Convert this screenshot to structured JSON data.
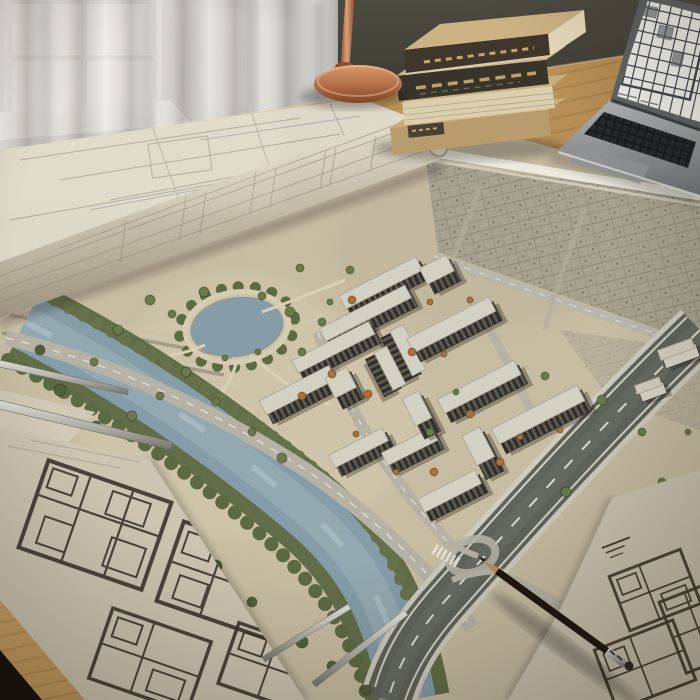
{
  "scene": {
    "description": "Photorealistic architect's desk: rolled blueprint, aerial 3D site-plan map of a riverside residential development blended into the tabletop, floor-plan sheets, pencil, metal rulers, stack of books, copper desk lamp, laptop showing a floor plan, sheer-curtained window",
    "legible_text": "none (all drawing annotations and book-spine lettering are illegible)"
  },
  "palette": {
    "sand": "#c7bda3",
    "sandLight": "#d4cbb0",
    "water": "#849da9",
    "bank": "#57643f",
    "roadLight": "#b6b3a6",
    "roadDark": "#60645b",
    "roof": "#d3d0c4",
    "wood": "#c59d63",
    "wallDark": "#44433a",
    "curtain": "#d9d8d4",
    "paper": "#cdc5b2",
    "ink": "#38322a",
    "copper": "#b5714a",
    "aluminum": "#8f9193",
    "treeGreen": "#6a7a4a",
    "treeDark": "#50603c",
    "treeOrange": "#b06f35",
    "pencilBrown": "#5d432f"
  },
  "map": {
    "pond": {
      "x": 237,
      "y": 327,
      "rx": 46,
      "ry": 29
    },
    "river": {
      "from": "upper-left",
      "to": "bottom-center",
      "tree_lined": true
    },
    "city_grid": "existing low-rise fabric upper-right",
    "highway": "multi-lane diagonal lower-right with loop ramp",
    "buildings": [
      {
        "x": 398,
        "y": 286,
        "rot": -27,
        "parts": [
          {
            "dx": -12,
            "dy": -4,
            "w": 86,
            "h": 20
          },
          {
            "dx": 44,
            "dy": 10,
            "w": 30,
            "h": 24
          }
        ]
      },
      {
        "x": 370,
        "y": 318,
        "rot": -27,
        "parts": [
          {
            "dx": 0,
            "dy": 0,
            "w": 96,
            "h": 19
          }
        ]
      },
      {
        "x": 338,
        "y": 352,
        "rot": -27,
        "parts": [
          {
            "dx": 0,
            "dy": 0,
            "w": 86,
            "h": 19
          }
        ]
      },
      {
        "x": 312,
        "y": 388,
        "rot": -27,
        "parts": [
          {
            "dx": -12,
            "dy": 2,
            "w": 78,
            "h": 21
          },
          {
            "dx": 30,
            "dy": 16,
            "w": 24,
            "h": 30
          }
        ]
      },
      {
        "x": 394,
        "y": 364,
        "rot": 63,
        "parts": [
          {
            "dx": -4,
            "dy": -12,
            "w": 50,
            "h": 20
          },
          {
            "dx": 4,
            "dy": 12,
            "w": 42,
            "h": 19
          }
        ]
      },
      {
        "x": 456,
        "y": 330,
        "rot": -27,
        "parts": [
          {
            "dx": 0,
            "dy": 0,
            "w": 92,
            "h": 21
          }
        ]
      },
      {
        "x": 484,
        "y": 392,
        "rot": -27,
        "parts": [
          {
            "dx": 0,
            "dy": 0,
            "w": 86,
            "h": 21
          }
        ]
      },
      {
        "x": 390,
        "y": 448,
        "rot": -27,
        "parts": [
          {
            "dx": -26,
            "dy": -8,
            "w": 60,
            "h": 19
          },
          {
            "dx": 20,
            "dy": 14,
            "w": 56,
            "h": 19
          },
          {
            "dx": 44,
            "dy": -14,
            "w": 18,
            "h": 40
          }
        ]
      },
      {
        "x": 464,
        "y": 480,
        "rot": -27,
        "parts": [
          {
            "dx": -16,
            "dy": 10,
            "w": 64,
            "h": 20
          },
          {
            "dx": 30,
            "dy": -14,
            "w": 20,
            "h": 44
          }
        ]
      },
      {
        "x": 543,
        "y": 420,
        "rot": -27,
        "parts": [
          {
            "dx": 0,
            "dy": 0,
            "w": 96,
            "h": 23
          }
        ]
      },
      {
        "x": 680,
        "y": 354,
        "rot": -20,
        "light": true,
        "parts": [
          {
            "dx": 0,
            "dy": 0,
            "w": 36,
            "h": 14
          }
        ]
      },
      {
        "x": 652,
        "y": 390,
        "rot": -20,
        "light": true,
        "parts": [
          {
            "dx": 0,
            "dy": 0,
            "w": 26,
            "h": 12
          }
        ]
      }
    ],
    "trees": [
      [
        150,
        300,
        5,
        "g"
      ],
      [
        172,
        314,
        4,
        "g"
      ],
      [
        204,
        292,
        5,
        "g"
      ],
      [
        262,
        296,
        4,
        "g"
      ],
      [
        290,
        312,
        5,
        "g"
      ],
      [
        186,
        372,
        5,
        "g"
      ],
      [
        160,
        396,
        4,
        "g"
      ],
      [
        216,
        402,
        4,
        "g"
      ],
      [
        302,
        352,
        4,
        "g"
      ],
      [
        322,
        322,
        4,
        "g"
      ],
      [
        118,
        330,
        5,
        "g"
      ],
      [
        94,
        362,
        4,
        "g"
      ],
      [
        132,
        416,
        5,
        "g"
      ],
      [
        252,
        432,
        4,
        "g"
      ],
      [
        282,
        458,
        5,
        "g"
      ],
      [
        330,
        302,
        3,
        "g"
      ],
      [
        350,
        270,
        4,
        "g"
      ],
      [
        300,
        268,
        4,
        "g"
      ],
      [
        258,
        352,
        3,
        "g"
      ],
      [
        225,
        358,
        3,
        "g"
      ],
      [
        352,
        300,
        4,
        "o"
      ],
      [
        332,
        374,
        4,
        "o"
      ],
      [
        368,
        394,
        4,
        "o"
      ],
      [
        302,
        396,
        4,
        "o"
      ],
      [
        412,
        352,
        4,
        "o"
      ],
      [
        444,
        354,
        3,
        "o"
      ],
      [
        470,
        414,
        4,
        "o"
      ],
      [
        434,
        472,
        4,
        "o"
      ],
      [
        500,
        462,
        4,
        "o"
      ],
      [
        356,
        434,
        3,
        "o"
      ],
      [
        396,
        472,
        3,
        "o"
      ],
      [
        520,
        437,
        3,
        "o"
      ],
      [
        560,
        430,
        3,
        "o"
      ],
      [
        470,
        300,
        3,
        "o"
      ],
      [
        430,
        302,
        3,
        "o"
      ],
      [
        545,
        376,
        4,
        "g"
      ],
      [
        602,
        400,
        5,
        "g"
      ],
      [
        642,
        432,
        4,
        "g"
      ],
      [
        566,
        492,
        5,
        "g"
      ],
      [
        612,
        522,
        4,
        "g"
      ],
      [
        662,
        482,
        4,
        "g"
      ],
      [
        688,
        432,
        3,
        "g"
      ],
      [
        430,
        432,
        4,
        "g"
      ],
      [
        456,
        392,
        3,
        "g"
      ],
      [
        590,
        560,
        4,
        "g"
      ],
      [
        634,
        586,
        4,
        "g"
      ],
      [
        60,
        390,
        6,
        "d"
      ],
      [
        96,
        426,
        5,
        "d"
      ],
      [
        70,
        456,
        6,
        "d"
      ],
      [
        120,
        470,
        5,
        "d"
      ],
      [
        152,
        506,
        6,
        "d"
      ],
      [
        186,
        542,
        5,
        "d"
      ],
      [
        216,
        566,
        6,
        "d"
      ],
      [
        252,
        602,
        5,
        "d"
      ],
      [
        302,
        642,
        6,
        "d"
      ],
      [
        332,
        666,
        5,
        "d"
      ],
      [
        366,
        690,
        5,
        "d"
      ],
      [
        40,
        350,
        5,
        "d"
      ]
    ]
  },
  "props": {
    "books": {
      "count": 4,
      "style": "kraft-covered, dark spines with faint gold lettering (illegible)"
    },
    "lamp": {
      "material": "copper",
      "visible": "pole and round base"
    },
    "laptop": {
      "screen_content": "white floor-plan document with dark grid lines",
      "body": "space gray"
    },
    "pencil": {
      "color": "dark brown",
      "detail": "sharpened tip upper-left, metal ferrule lower-right"
    },
    "sheets": [
      {
        "position": "bottom-left",
        "content": "dark-ink floor-plan grids"
      },
      {
        "position": "bottom-right",
        "content": "floor-plan grids with tiny illegible title block"
      },
      {
        "position": "upper-left",
        "content": "partially rolled blueprint with faint plan sketches"
      }
    ],
    "rulers": {
      "count": 4,
      "material": "metal straightedges"
    }
  }
}
